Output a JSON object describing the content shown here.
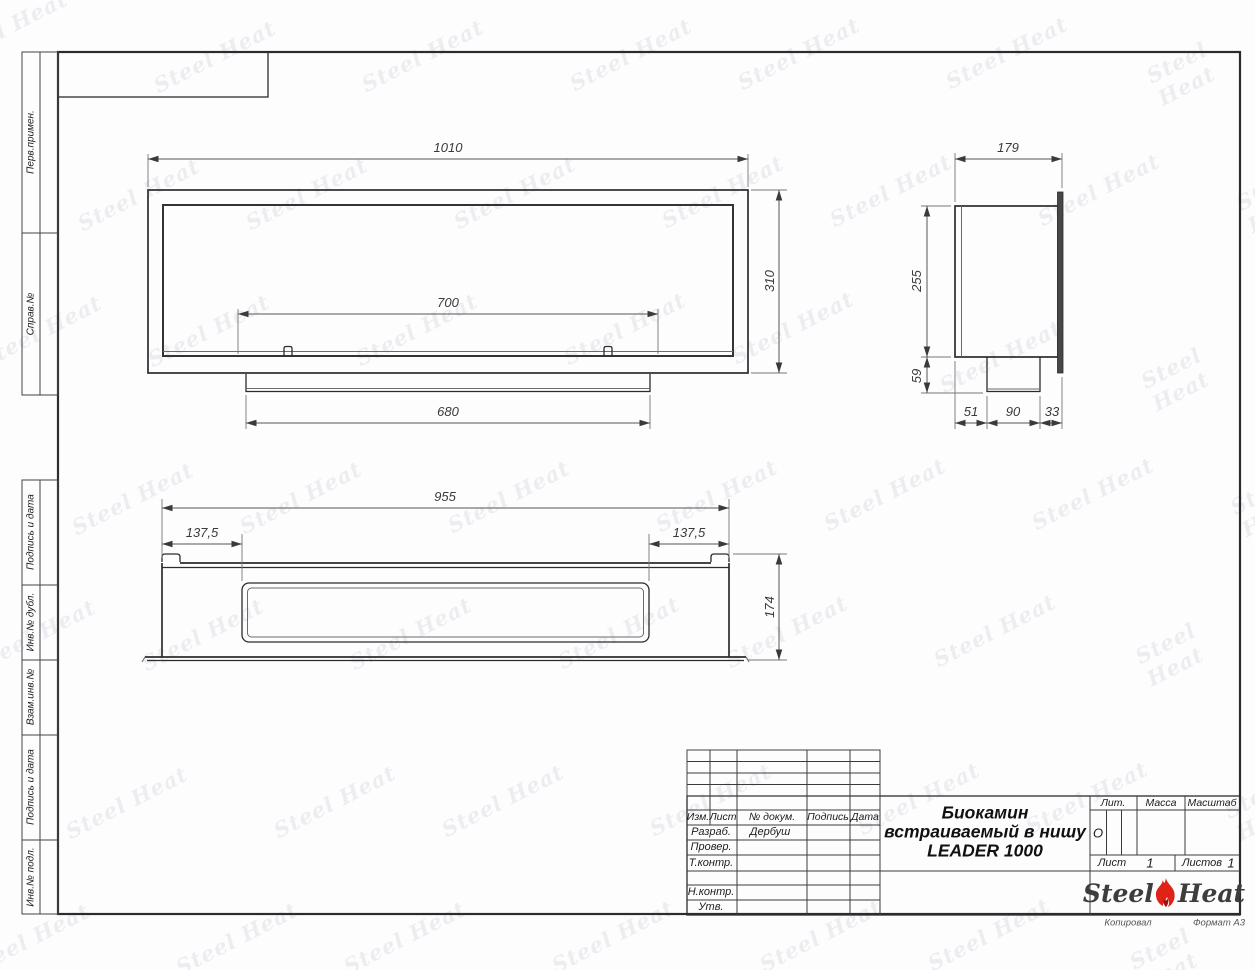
{
  "watermark": {
    "text": "Steel Heat",
    "color": "#748098"
  },
  "margin_labels": {
    "perv": "Перв.примен.",
    "sprav": "Справ.№",
    "podpis1": "Подпись и дата",
    "inv_dubl": "Инв.№ дубл.",
    "vzamen": "Взам.инв.№",
    "podpis2": "Подпись и дата",
    "inv_podl": "Инв.№ подл."
  },
  "dims": {
    "front_width": "1010",
    "front_height": "310",
    "front_opening": "700",
    "front_tray": "680",
    "side_depth": "179",
    "side_height": "255",
    "side_drop": "59",
    "side_b1": "51",
    "side_b2": "90",
    "side_b3": "33",
    "bottom_width": "955",
    "bottom_offset_left": "137,5",
    "bottom_offset_right": "137,5",
    "bottom_height": "174"
  },
  "title_block": {
    "cols": {
      "izm": "Изм.",
      "list": "Лист",
      "doc": "№ докум.",
      "podpis": "Подпись",
      "data": "Дата"
    },
    "rows": [
      {
        "label": "Разраб.",
        "value": "Дербуш"
      },
      {
        "label": "Провер.",
        "value": ""
      },
      {
        "label": "Т.контр.",
        "value": ""
      },
      {
        "label": "",
        "value": ""
      },
      {
        "label": "Н.контр.",
        "value": ""
      },
      {
        "label": "Утв.",
        "value": ""
      }
    ],
    "title_line1": "Биокамин",
    "title_line2": "встраиваемый в нишу",
    "title_line3": "LEADER 1000",
    "lit": "Лит.",
    "lit_value": "О",
    "massa": "Масса",
    "masshtab": "Масштаб",
    "list_label": "Лист",
    "list_value": "1",
    "listov_label": "Листов",
    "listov_value": "1",
    "logo_left": "Steel",
    "logo_right": "Heat",
    "kopiroval": "Копировал",
    "format": "Формат А3"
  }
}
